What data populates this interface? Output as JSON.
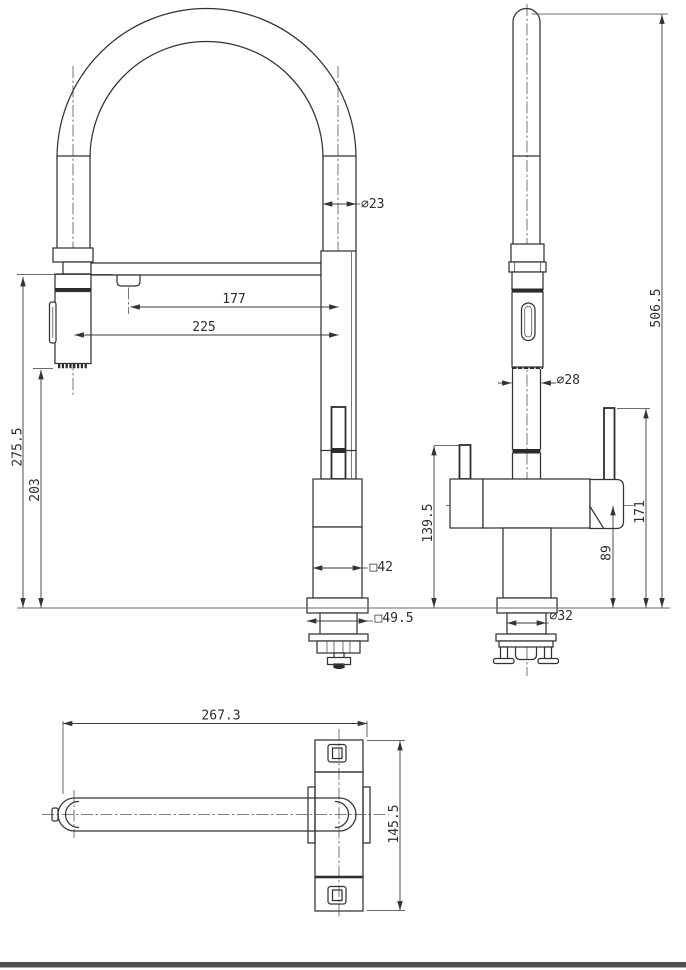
{
  "drawing": {
    "colors": {
      "line": "#333333",
      "seam": "#2b2b2b",
      "centerline": "#555555",
      "background": "#ffffff",
      "footer_bar": "#4f4f4f"
    },
    "front": {
      "hose_diameter": "⌀23",
      "spout_reach": "177",
      "spray_reach": "225",
      "spout_height": "275.5",
      "spray_outlet_height": "203",
      "body_width": "□42",
      "base_width": "□49.5"
    },
    "side": {
      "overall_height": "506.5",
      "column_diameter": "⌀28",
      "left_handle_height": "139.5",
      "right_handle_height": "171",
      "body_center_height": "89",
      "shank_diameter": "⌀32"
    },
    "top": {
      "overall_length": "267.3",
      "overall_depth": "145.5"
    }
  }
}
